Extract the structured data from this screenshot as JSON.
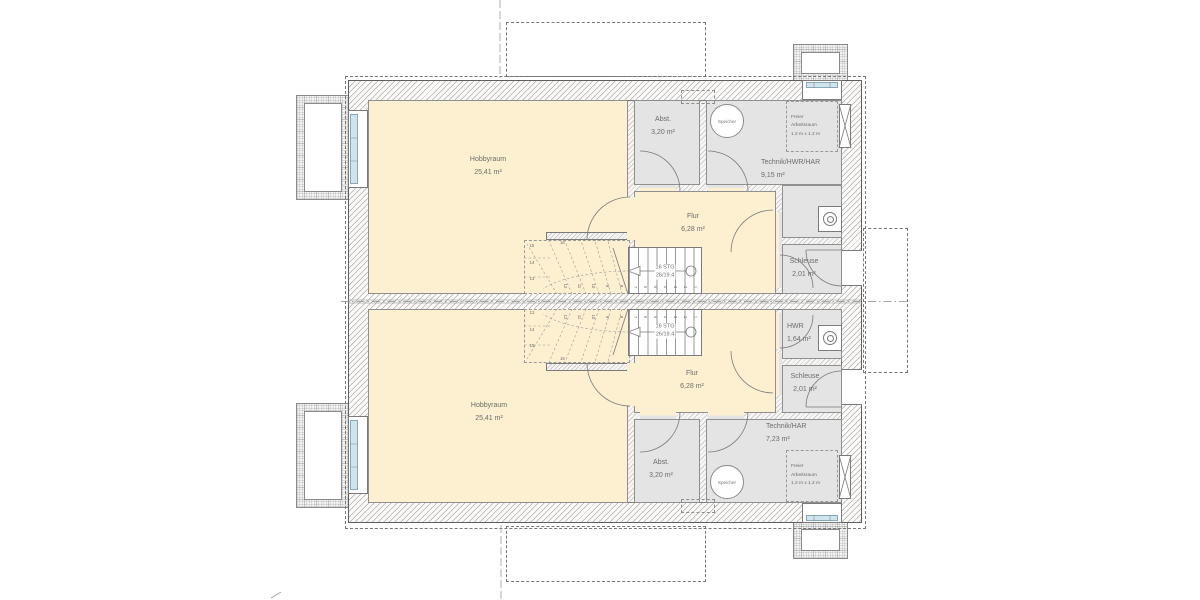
{
  "colors": {
    "room_warm_yellow": "#fdf0d0",
    "room_gray": "#e4e4e4",
    "window_glass_blue": "#cfe4ec",
    "wall_line_gray": "#777777"
  },
  "rooms": {
    "top": {
      "hobbyraum": {
        "name": "Hobbyraum",
        "area": "25,41 m²"
      },
      "abstell": {
        "name": "Abst.",
        "area": "3,20 m²"
      },
      "technik": {
        "name": "Technik/HWR/HAR",
        "area": "9,15 m²"
      },
      "flur": {
        "name": "Flur",
        "area": "6,28 m²"
      },
      "schleuse": {
        "name": "Schleuse",
        "area": "2,01 m²"
      },
      "speicher": "Speicher",
      "arbeitsraum": {
        "line1": "Freier",
        "line2": "Arbeitsraum",
        "line3": "1.2 m x 1.2 m"
      }
    },
    "bottom": {
      "hobbyraum": {
        "name": "Hobbyraum",
        "area": "25,41 m²"
      },
      "abstell": {
        "name": "Abst.",
        "area": "3,20 m²"
      },
      "technik": {
        "name": "Technik/HAR",
        "area": "7,23 m²"
      },
      "flur": {
        "name": "Flur",
        "area": "6,28 m²"
      },
      "schleuse": {
        "name": "Schleuse",
        "area": "2,01 m²"
      },
      "hwr": {
        "name": "HWR",
        "area": "1,64 m²"
      },
      "speicher": "Speicher",
      "arbeitsraum": {
        "line1": "Freier",
        "line2": "Arbeitsraum",
        "line3": "1.2 m x 1.2 m"
      }
    }
  },
  "stairs": {
    "label_line1": "16 STG",
    "label_line2": "26/19.4",
    "straight": [
      "1",
      "2",
      "3",
      "4",
      "5",
      "6",
      "7"
    ],
    "winder_rot": [
      "8",
      "9",
      "10",
      "11",
      "12"
    ],
    "winder_col": [
      "13",
      "14",
      "15"
    ],
    "top_step": "16"
  }
}
